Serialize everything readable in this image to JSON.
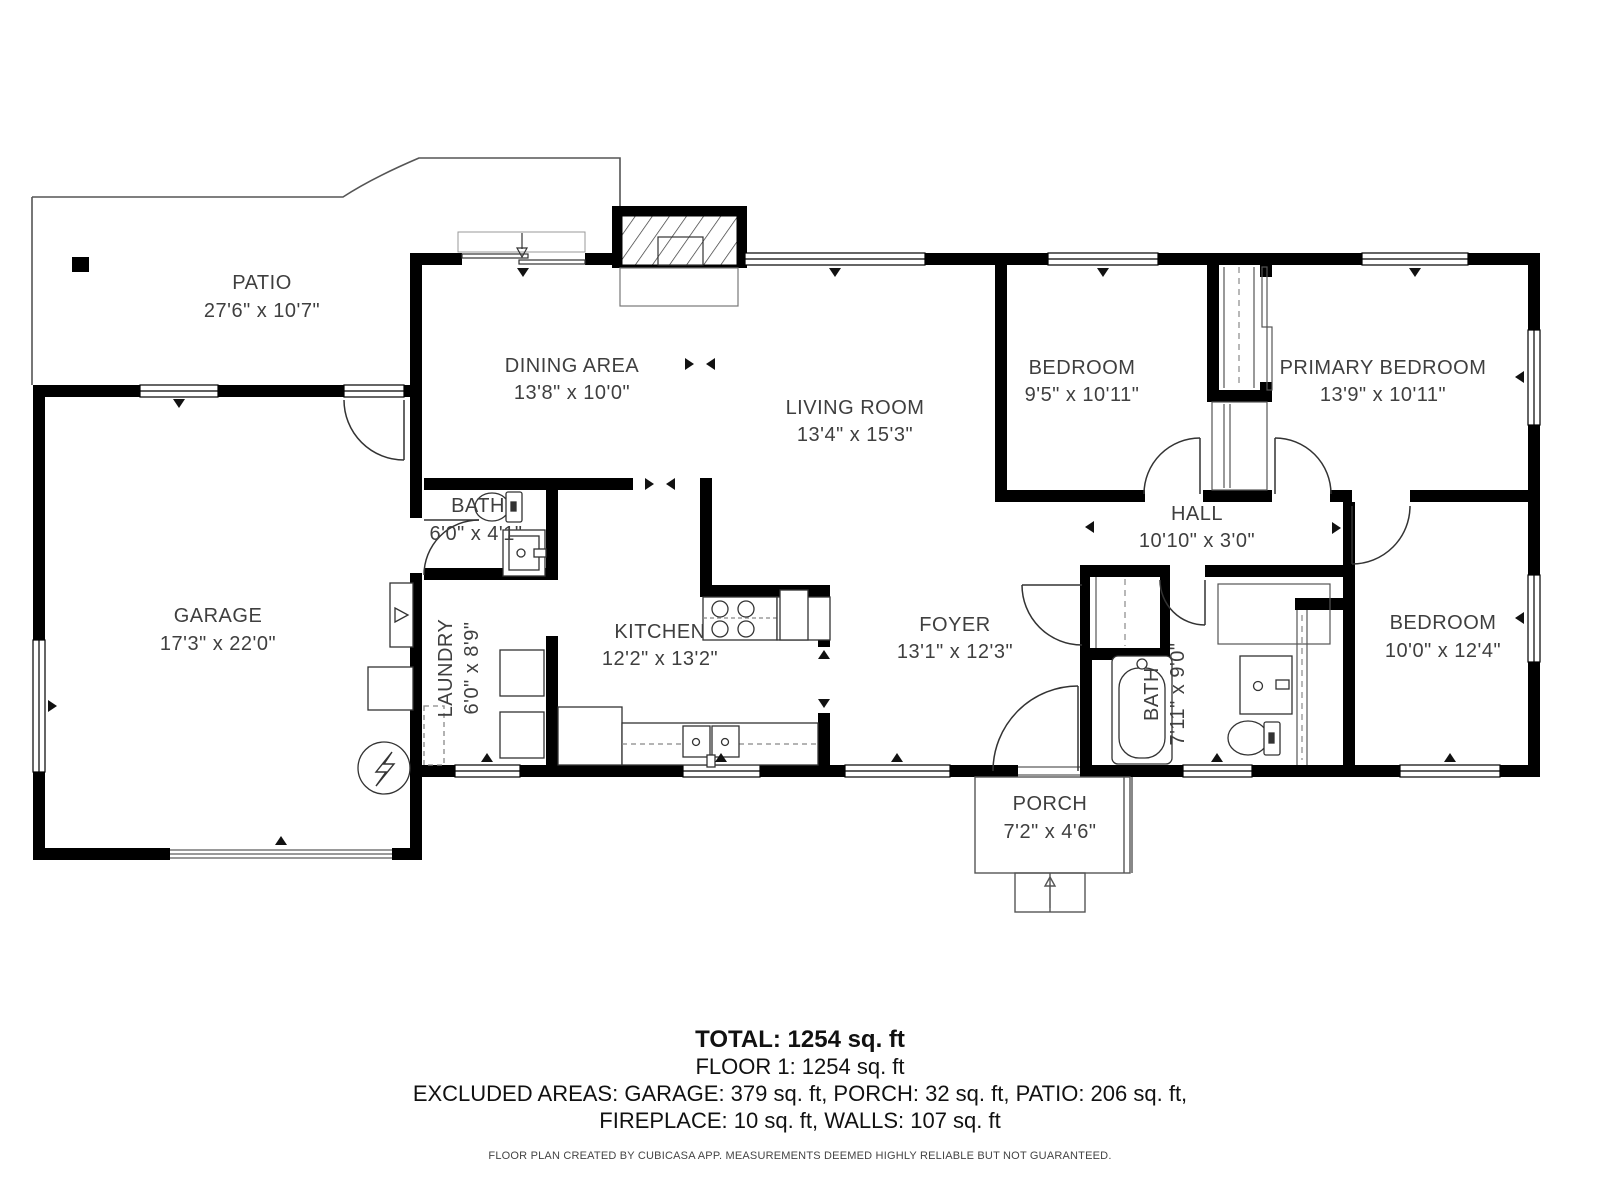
{
  "plan": {
    "rooms": [
      {
        "name": "PATIO",
        "dims": "27'6\" x 10'7\""
      },
      {
        "name": "DINING AREA",
        "dims": "13'8\" x 10'0\""
      },
      {
        "name": "LIVING ROOM",
        "dims": "13'4\" x 15'3\""
      },
      {
        "name": "BEDROOM",
        "dims": "9'5\" x 10'11\""
      },
      {
        "name": "PRIMARY BEDROOM",
        "dims": "13'9\" x 10'11\""
      },
      {
        "name": "GARAGE",
        "dims": "17'3\" x 22'0\""
      },
      {
        "name": "BATH",
        "dims": "6'0\" x 4'1\""
      },
      {
        "name": "LAUNDRY",
        "dims": "6'0\" x 8'9\""
      },
      {
        "name": "KITCHEN",
        "dims": "12'2\" x 13'2\""
      },
      {
        "name": "FOYER",
        "dims": "13'1\" x 12'3\""
      },
      {
        "name": "HALL",
        "dims": "10'10\" x 3'0\""
      },
      {
        "name": "BATH",
        "dims": "7'11\" x 9'0\""
      },
      {
        "name": "BEDROOM",
        "dims": "10'0\" x 12'4\""
      },
      {
        "name": "PORCH",
        "dims": "7'2\" x 4'6\""
      }
    ],
    "summary": {
      "total": "TOTAL: 1254 sq. ft",
      "floor1": "FLOOR 1: 1254 sq. ft",
      "excluded1": "EXCLUDED AREAS: GARAGE: 379 sq. ft, PORCH: 32 sq. ft, PATIO: 206 sq. ft,",
      "excluded2": "FIREPLACE: 10 sq. ft, WALLS: 107 sq. ft"
    },
    "disclaimer": "FLOOR PLAN CREATED BY CUBICASA APP. MEASUREMENTS DEEMED HIGHLY RELIABLE BUT NOT GUARANTEED.",
    "colors": {
      "wall": "#000000",
      "text": "#3f3f3f",
      "thin_line": "#555555"
    }
  }
}
